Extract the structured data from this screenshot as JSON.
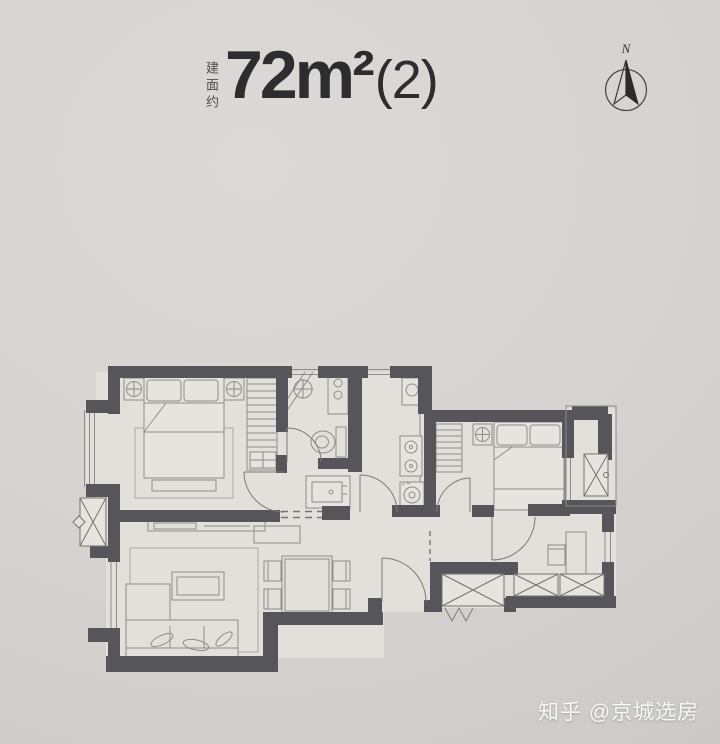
{
  "header": {
    "area_label": "建面约",
    "area_value": "72m²",
    "area_suffix": "(2)"
  },
  "compass": {
    "north_label": "N"
  },
  "watermark": {
    "text": "知乎 @京城选房"
  },
  "colors": {
    "background": "#d6d4d1",
    "wall": "#55555a",
    "furniture_line": "#8f8d88",
    "room_fill": "#e2e0db",
    "title_text": "#2d2d2f",
    "watermark_text": "#f8f7f5"
  }
}
